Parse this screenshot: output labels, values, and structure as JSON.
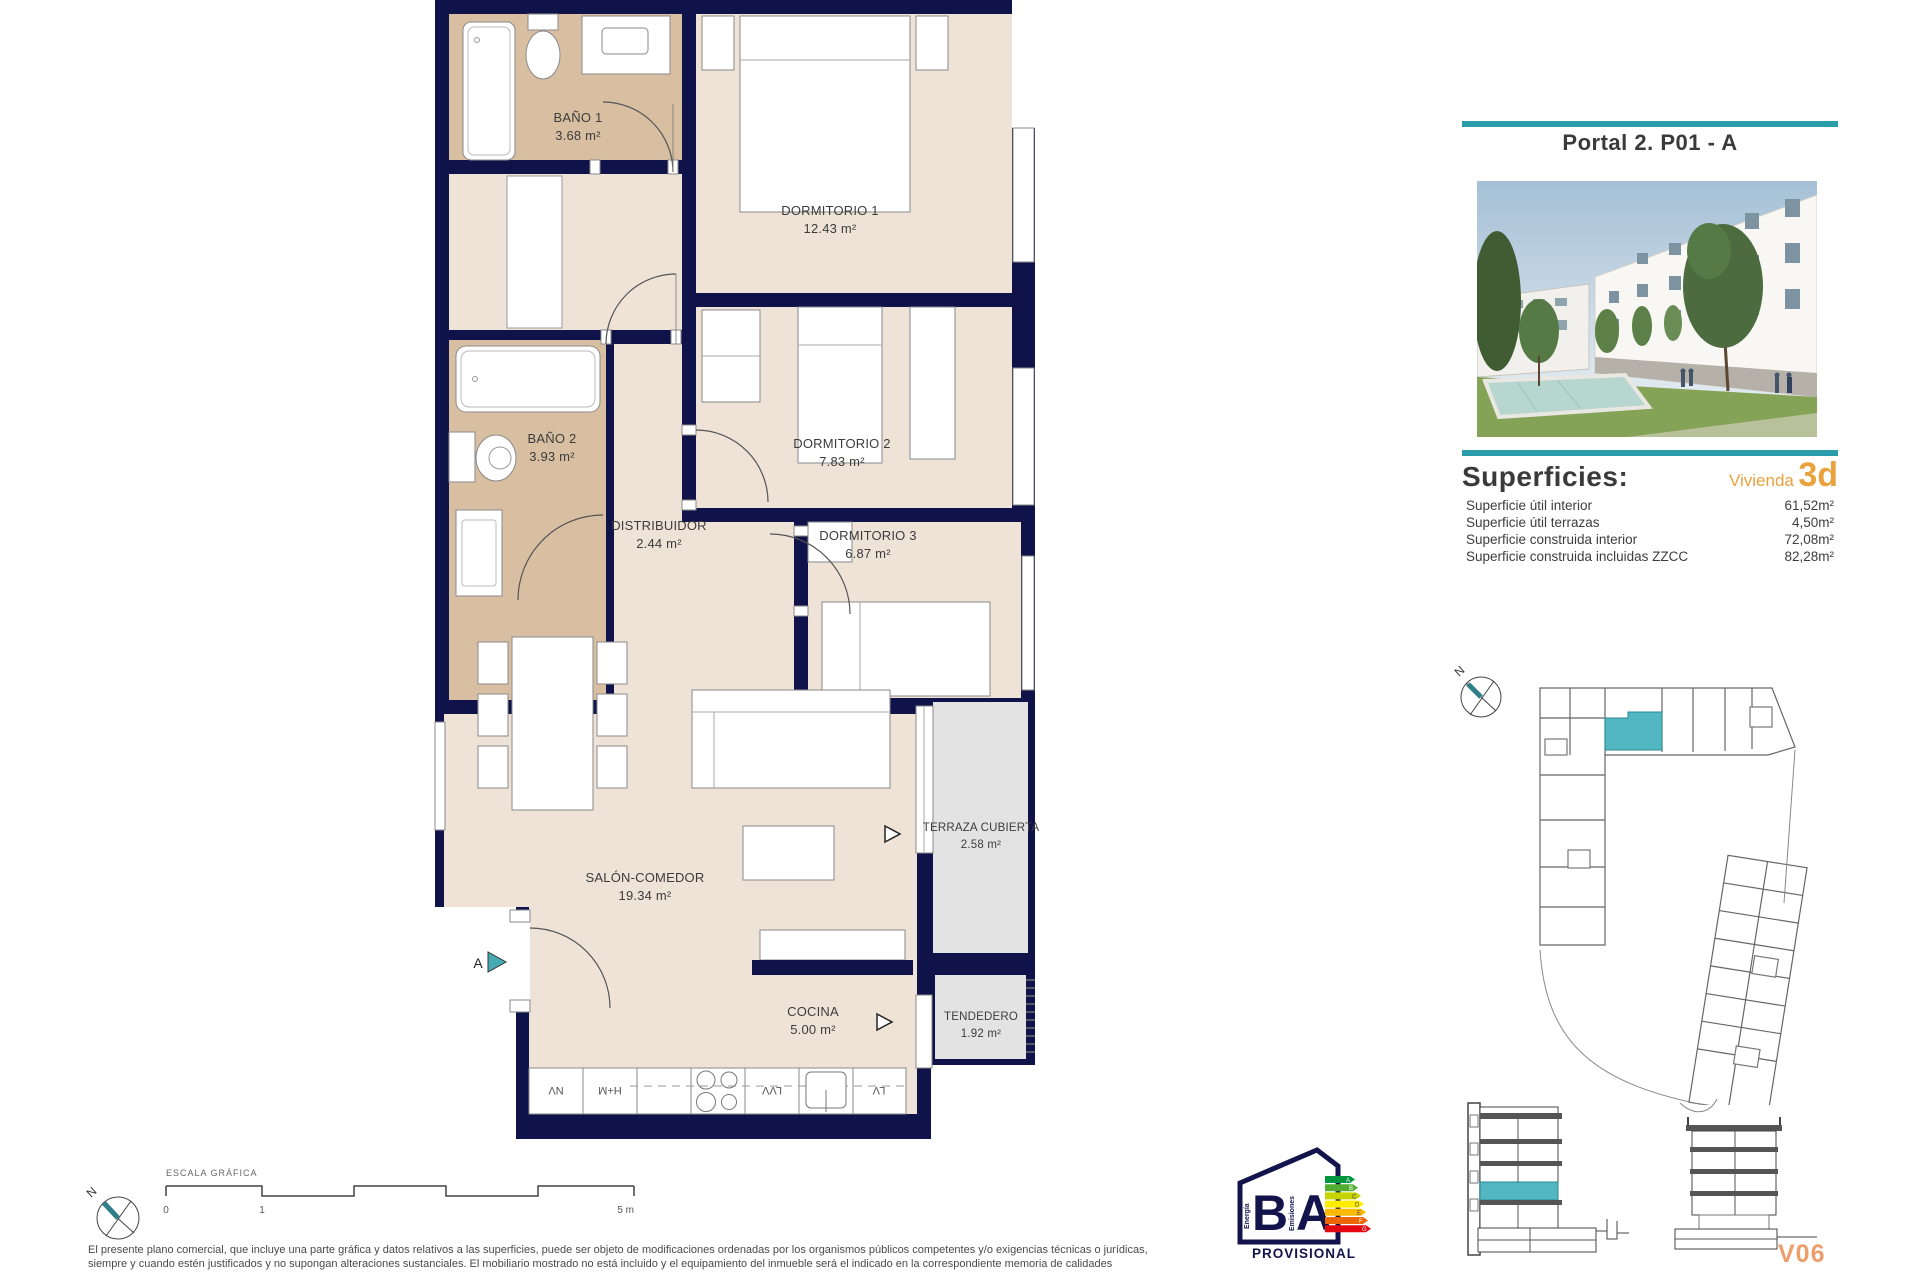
{
  "panel": {
    "title": "Portal 2. P01 - A",
    "superficies_title": "Superficies:",
    "vivienda_label": "Vivienda",
    "vivienda_type": "3d",
    "rows": [
      {
        "label": "Superficie útil interior",
        "value": "61,52m²"
      },
      {
        "label": "Superficie útil terrazas",
        "value": "4,50m²"
      },
      {
        "label": "Superficie construida interior",
        "value": "72,08m²"
      },
      {
        "label": "Superficie construida incluidas ZZCC",
        "value": "82,28m²"
      }
    ],
    "code": "V06"
  },
  "rooms": {
    "bano1": {
      "name": "BAÑO 1",
      "area": "3.68 m²"
    },
    "dormitorio1": {
      "name": "DORMITORIO 1",
      "area": "12.43 m²"
    },
    "dormitorio2": {
      "name": "DORMITORIO 2",
      "area": "7.83 m²"
    },
    "bano2": {
      "name": "BAÑO 2",
      "area": "3.93 m²"
    },
    "distribuidor": {
      "name": "DISTRIBUIDOR",
      "area": "2.44 m²"
    },
    "dormitorio3": {
      "name": "DORMITORIO 3",
      "area": "6.87 m²"
    },
    "salon": {
      "name": "SALÓN-COMEDOR",
      "area": "19.34 m²"
    },
    "terraza": {
      "name": "TERRAZA CUBIERTA",
      "area": "2.58 m²"
    },
    "cocina": {
      "name": "COCINA",
      "area": "5.00 m²"
    },
    "tendedero": {
      "name": "TENDEDERO",
      "area": "1.92 m²"
    }
  },
  "kitchen": {
    "nv": "NV",
    "hm": "H+M",
    "lvv": "LVV",
    "lv": "LV"
  },
  "markers": {
    "section_a": "A"
  },
  "compass": {
    "n": "N"
  },
  "scalebar": {
    "title": "ESCALA GRÁFICA",
    "t0": "0",
    "t1": "1",
    "t5": "5 m"
  },
  "energy": {
    "b": "B",
    "a": "A",
    "energia": "Energía",
    "emisiones": "Emisiones",
    "provisional": "PROVISIONAL",
    "letters": [
      "A",
      "B",
      "C",
      "D",
      "E",
      "F",
      "G"
    ],
    "arrow_colors": [
      "#009640",
      "#52ae32",
      "#c8d400",
      "#ffed00",
      "#fbba00",
      "#ec6608",
      "#e30613"
    ]
  },
  "colors": {
    "wall": "#101349",
    "floor": "#efe3d8",
    "bath": "#d9bfa1",
    "terrace": "#e3e3e4",
    "teal": "#2b9caa",
    "unit_highlight": "#52b7c0",
    "orange": "#eaa23d"
  },
  "disclaimer": {
    "line1": "El presente plano comercial, que incluye una parte gráfica y datos relativos a las superficies, puede ser objeto de modificaciones ordenadas por los organismos públicos competentes y/o exigencias técnicas o jurídicas,",
    "line2": "siempre y cuando estén justificados y no supongan alteraciones sustanciales. El mobiliario mostrado no está incluido y el equipamiento del inmueble será el indicado en la correspondiente memoria de calidades"
  }
}
